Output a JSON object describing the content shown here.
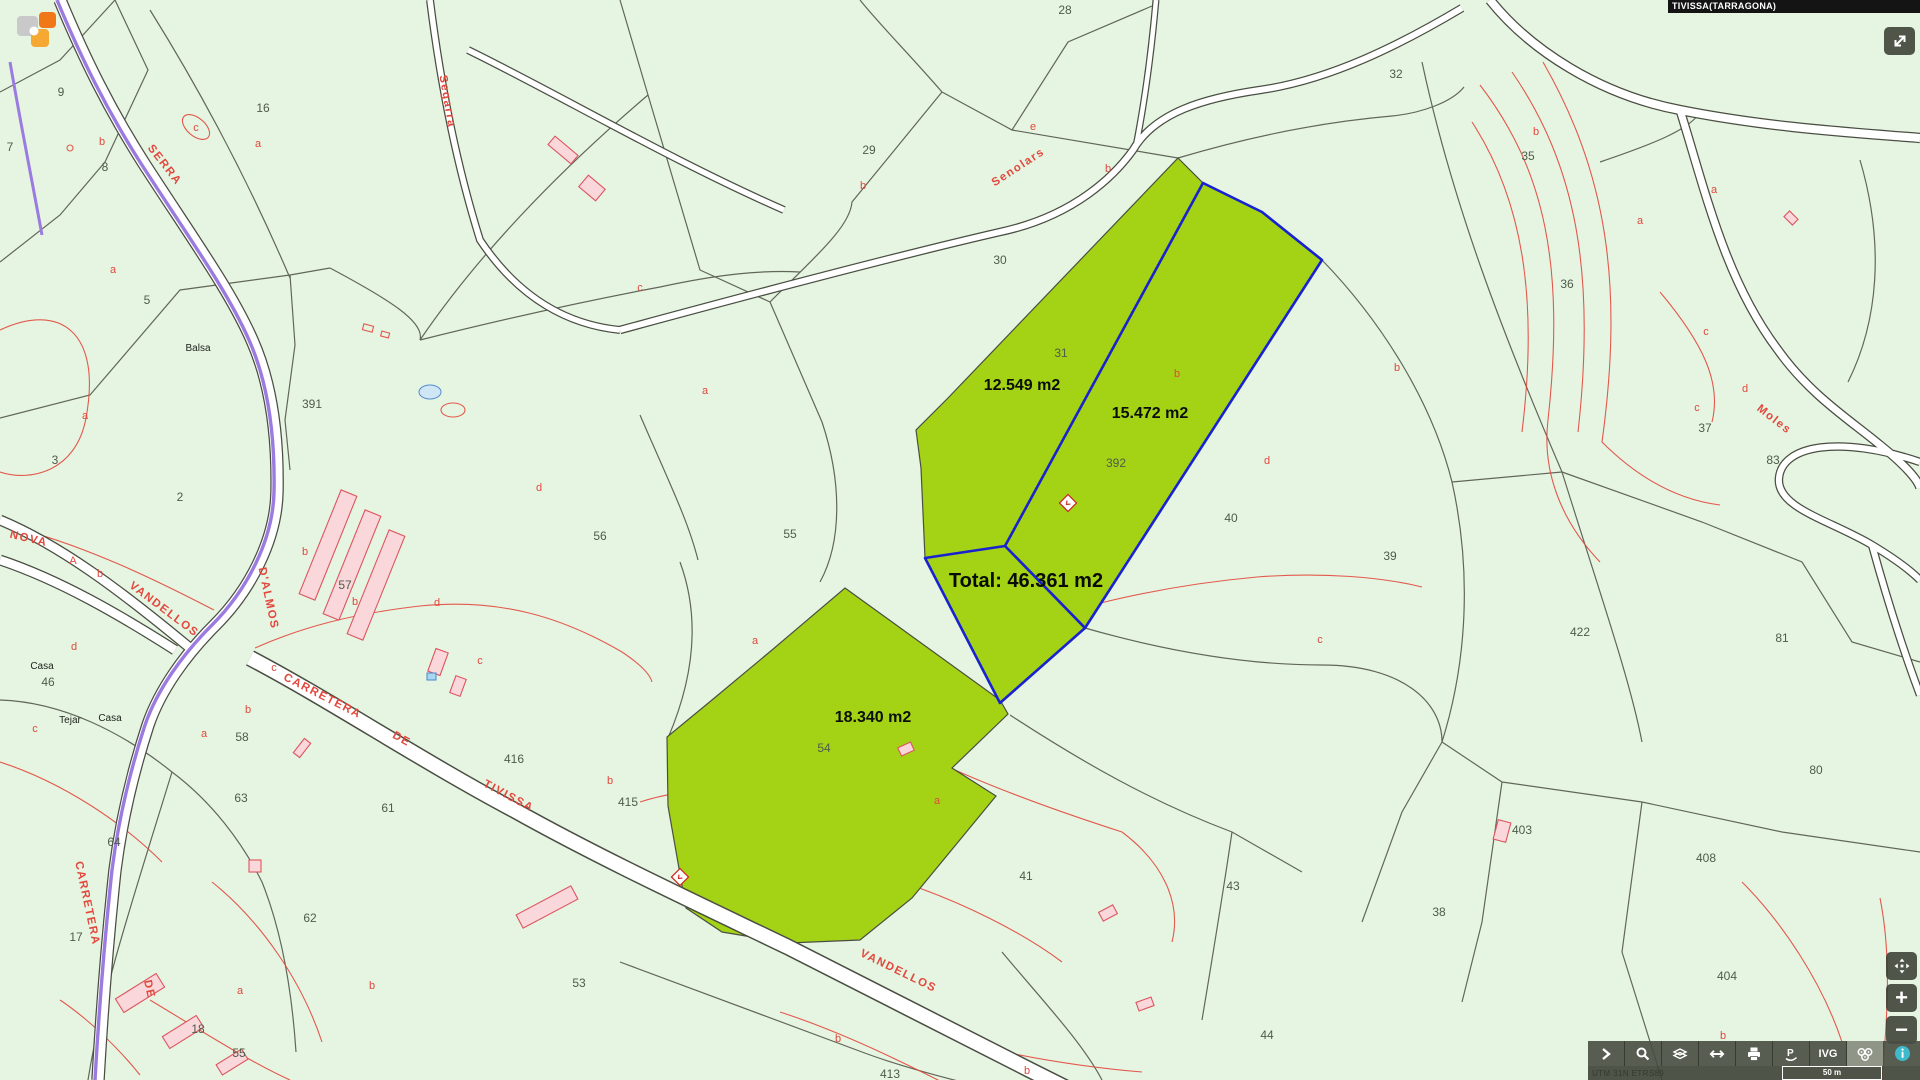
{
  "app": {
    "municipality_label": "TIVISSA(TARRAGONA)"
  },
  "colors": {
    "background": "#e6f5e2",
    "parcel_line": "#4a4e42",
    "subparcel_line": "#e2483d",
    "highlight_green": "#a4d316",
    "selection_blue": "#1822cf",
    "road_purple": "#9b7be0",
    "building_pink": "#f9d7da",
    "toolbar_dark": "#484d42",
    "info_teal": "#3fb9cc"
  },
  "map": {
    "area_labels": [
      {
        "t": "12.549 m2",
        "x": 1022,
        "y": 390
      },
      {
        "t": "15.472 m2",
        "x": 1150,
        "y": 418
      },
      {
        "t": "18.340 m2",
        "x": 873,
        "y": 722
      }
    ],
    "total_labels": [
      {
        "t": "Total: 46.361 m2",
        "x": 1026,
        "y": 587
      }
    ],
    "parcel_numbers": [
      {
        "t": "28",
        "x": 1065,
        "y": 14
      },
      {
        "t": "32",
        "x": 1396,
        "y": 78
      },
      {
        "t": "35",
        "x": 1528,
        "y": 160
      },
      {
        "t": "29",
        "x": 869,
        "y": 154
      },
      {
        "t": "30",
        "x": 1000,
        "y": 264
      },
      {
        "t": "36",
        "x": 1567,
        "y": 288
      },
      {
        "t": "37",
        "x": 1705,
        "y": 432
      },
      {
        "t": "83",
        "x": 1773,
        "y": 464
      },
      {
        "t": "31",
        "x": 1061,
        "y": 357
      },
      {
        "t": "392",
        "x": 1116,
        "y": 467
      },
      {
        "t": "40",
        "x": 1231,
        "y": 522
      },
      {
        "t": "39",
        "x": 1390,
        "y": 560
      },
      {
        "t": "422",
        "x": 1580,
        "y": 636
      },
      {
        "t": "81",
        "x": 1782,
        "y": 642
      },
      {
        "t": "80",
        "x": 1816,
        "y": 774
      },
      {
        "t": "403",
        "x": 1522,
        "y": 834
      },
      {
        "t": "408",
        "x": 1706,
        "y": 862
      },
      {
        "t": "404",
        "x": 1727,
        "y": 980
      },
      {
        "t": "38",
        "x": 1439,
        "y": 916
      },
      {
        "t": "43",
        "x": 1233,
        "y": 890
      },
      {
        "t": "41",
        "x": 1026,
        "y": 880
      },
      {
        "t": "44",
        "x": 1267,
        "y": 1039
      },
      {
        "t": "54",
        "x": 824,
        "y": 752
      },
      {
        "t": "53",
        "x": 579,
        "y": 987
      },
      {
        "t": "415",
        "x": 628,
        "y": 806
      },
      {
        "t": "416",
        "x": 514,
        "y": 763
      },
      {
        "t": "55",
        "x": 790,
        "y": 538
      },
      {
        "t": "56",
        "x": 600,
        "y": 540
      },
      {
        "t": "63",
        "x": 241,
        "y": 802
      },
      {
        "t": "64",
        "x": 114,
        "y": 846
      },
      {
        "t": "61",
        "x": 388,
        "y": 812
      },
      {
        "t": "62",
        "x": 310,
        "y": 922
      },
      {
        "t": "17",
        "x": 76,
        "y": 941
      },
      {
        "t": "18",
        "x": 198,
        "y": 1033
      },
      {
        "t": "55",
        "x": 239,
        "y": 1057
      },
      {
        "t": "58",
        "x": 242,
        "y": 741
      },
      {
        "t": "46",
        "x": 48,
        "y": 686
      },
      {
        "t": "2",
        "x": 180,
        "y": 501
      },
      {
        "t": "3",
        "x": 55,
        "y": 464
      },
      {
        "t": "391",
        "x": 312,
        "y": 408
      },
      {
        "t": "5",
        "x": 147,
        "y": 304
      },
      {
        "t": "8",
        "x": 105,
        "y": 171
      },
      {
        "t": "9",
        "x": 61,
        "y": 96
      },
      {
        "t": "7",
        "x": 10,
        "y": 151
      },
      {
        "t": "16",
        "x": 263,
        "y": 112
      },
      {
        "t": "57",
        "x": 345,
        "y": 589
      },
      {
        "t": "413",
        "x": 890,
        "y": 1078
      }
    ],
    "subparcel_letters": [
      {
        "t": "b",
        "x": 1108,
        "y": 172
      },
      {
        "t": "e",
        "x": 1033,
        "y": 130
      },
      {
        "t": "b",
        "x": 1177,
        "y": 377
      },
      {
        "t": "d",
        "x": 1267,
        "y": 464
      },
      {
        "t": "b",
        "x": 1397,
        "y": 371
      },
      {
        "t": "a",
        "x": 1714,
        "y": 193
      },
      {
        "t": "c",
        "x": 1697,
        "y": 411
      },
      {
        "t": "d",
        "x": 1745,
        "y": 392
      },
      {
        "t": "b",
        "x": 1536,
        "y": 135
      },
      {
        "t": "a",
        "x": 1640,
        "y": 224
      },
      {
        "t": "c",
        "x": 1706,
        "y": 335
      },
      {
        "t": "a",
        "x": 258,
        "y": 147
      },
      {
        "t": "c",
        "x": 196,
        "y": 131
      },
      {
        "t": "b",
        "x": 102,
        "y": 145
      },
      {
        "t": "a",
        "x": 113,
        "y": 273
      },
      {
        "t": "a",
        "x": 85,
        "y": 419
      },
      {
        "t": "A",
        "x": 73,
        "y": 564
      },
      {
        "t": "b",
        "x": 100,
        "y": 577
      },
      {
        "t": "d",
        "x": 74,
        "y": 650
      },
      {
        "t": "d",
        "x": 437,
        "y": 606
      },
      {
        "t": "d",
        "x": 539,
        "y": 491
      },
      {
        "t": "c",
        "x": 640,
        "y": 291
      },
      {
        "t": "c",
        "x": 274,
        "y": 671
      },
      {
        "t": "b",
        "x": 248,
        "y": 713
      },
      {
        "t": "a",
        "x": 204,
        "y": 737
      },
      {
        "t": "c",
        "x": 35,
        "y": 732
      },
      {
        "t": "b",
        "x": 355,
        "y": 605
      },
      {
        "t": "a",
        "x": 937,
        "y": 804
      },
      {
        "t": "b",
        "x": 838,
        "y": 1042
      },
      {
        "t": "b",
        "x": 1027,
        "y": 1074
      },
      {
        "t": "b",
        "x": 1723,
        "y": 1039
      },
      {
        "t": "a",
        "x": 705,
        "y": 394
      },
      {
        "t": "b",
        "x": 305,
        "y": 555
      },
      {
        "t": "c",
        "x": 480,
        "y": 664
      },
      {
        "t": "a",
        "x": 755,
        "y": 644
      },
      {
        "t": "b",
        "x": 863,
        "y": 189
      },
      {
        "t": "c",
        "x": 1320,
        "y": 643
      },
      {
        "t": "b",
        "x": 610,
        "y": 784
      },
      {
        "t": "a",
        "x": 240,
        "y": 994
      },
      {
        "t": "b",
        "x": 372,
        "y": 989
      }
    ],
    "road_labels": [
      {
        "t": "SERRA",
        "x": 162,
        "y": 167,
        "rot": 52
      },
      {
        "t": "NOVA",
        "x": 28,
        "y": 542,
        "rot": 13
      },
      {
        "t": "VANDELLOS",
        "x": 162,
        "y": 612,
        "rot": 37
      },
      {
        "t": "D'ALMOS",
        "x": 265,
        "y": 599,
        "rot": 78
      },
      {
        "t": "CARRETERA",
        "x": 321,
        "y": 699,
        "rot": 27
      },
      {
        "t": "DE",
        "x": 400,
        "y": 742,
        "rot": 29
      },
      {
        "t": "TIVISSA",
        "x": 507,
        "y": 799,
        "rot": 28
      },
      {
        "t": "VANDELLOS",
        "x": 897,
        "y": 974,
        "rot": 26
      },
      {
        "t": "CARRETERA",
        "x": 84,
        "y": 904,
        "rot": 78
      },
      {
        "t": "DE",
        "x": 146,
        "y": 990,
        "rot": 78
      },
      {
        "t": "Moles",
        "x": 1772,
        "y": 422,
        "rot": 38
      },
      {
        "t": "Senolars",
        "x": 1020,
        "y": 170,
        "rot": -33
      },
      {
        "t": "Segarra",
        "x": 444,
        "y": 102,
        "rot": 80
      }
    ],
    "place_labels": [
      {
        "t": "Balsa",
        "x": 198,
        "y": 351
      },
      {
        "t": "Casa",
        "x": 42,
        "y": 669
      },
      {
        "t": "Casa",
        "x": 110,
        "y": 721
      },
      {
        "t": "Tejar",
        "x": 70,
        "y": 723
      }
    ]
  },
  "controls": {
    "zoom_in_glyph": "+",
    "zoom_out_glyph": "−"
  },
  "toolbar": {
    "ivg_label": "IVG",
    "pin_glyph": "P",
    "scale_label": "50 m",
    "attribution": "UTM 31N ETRS89"
  }
}
